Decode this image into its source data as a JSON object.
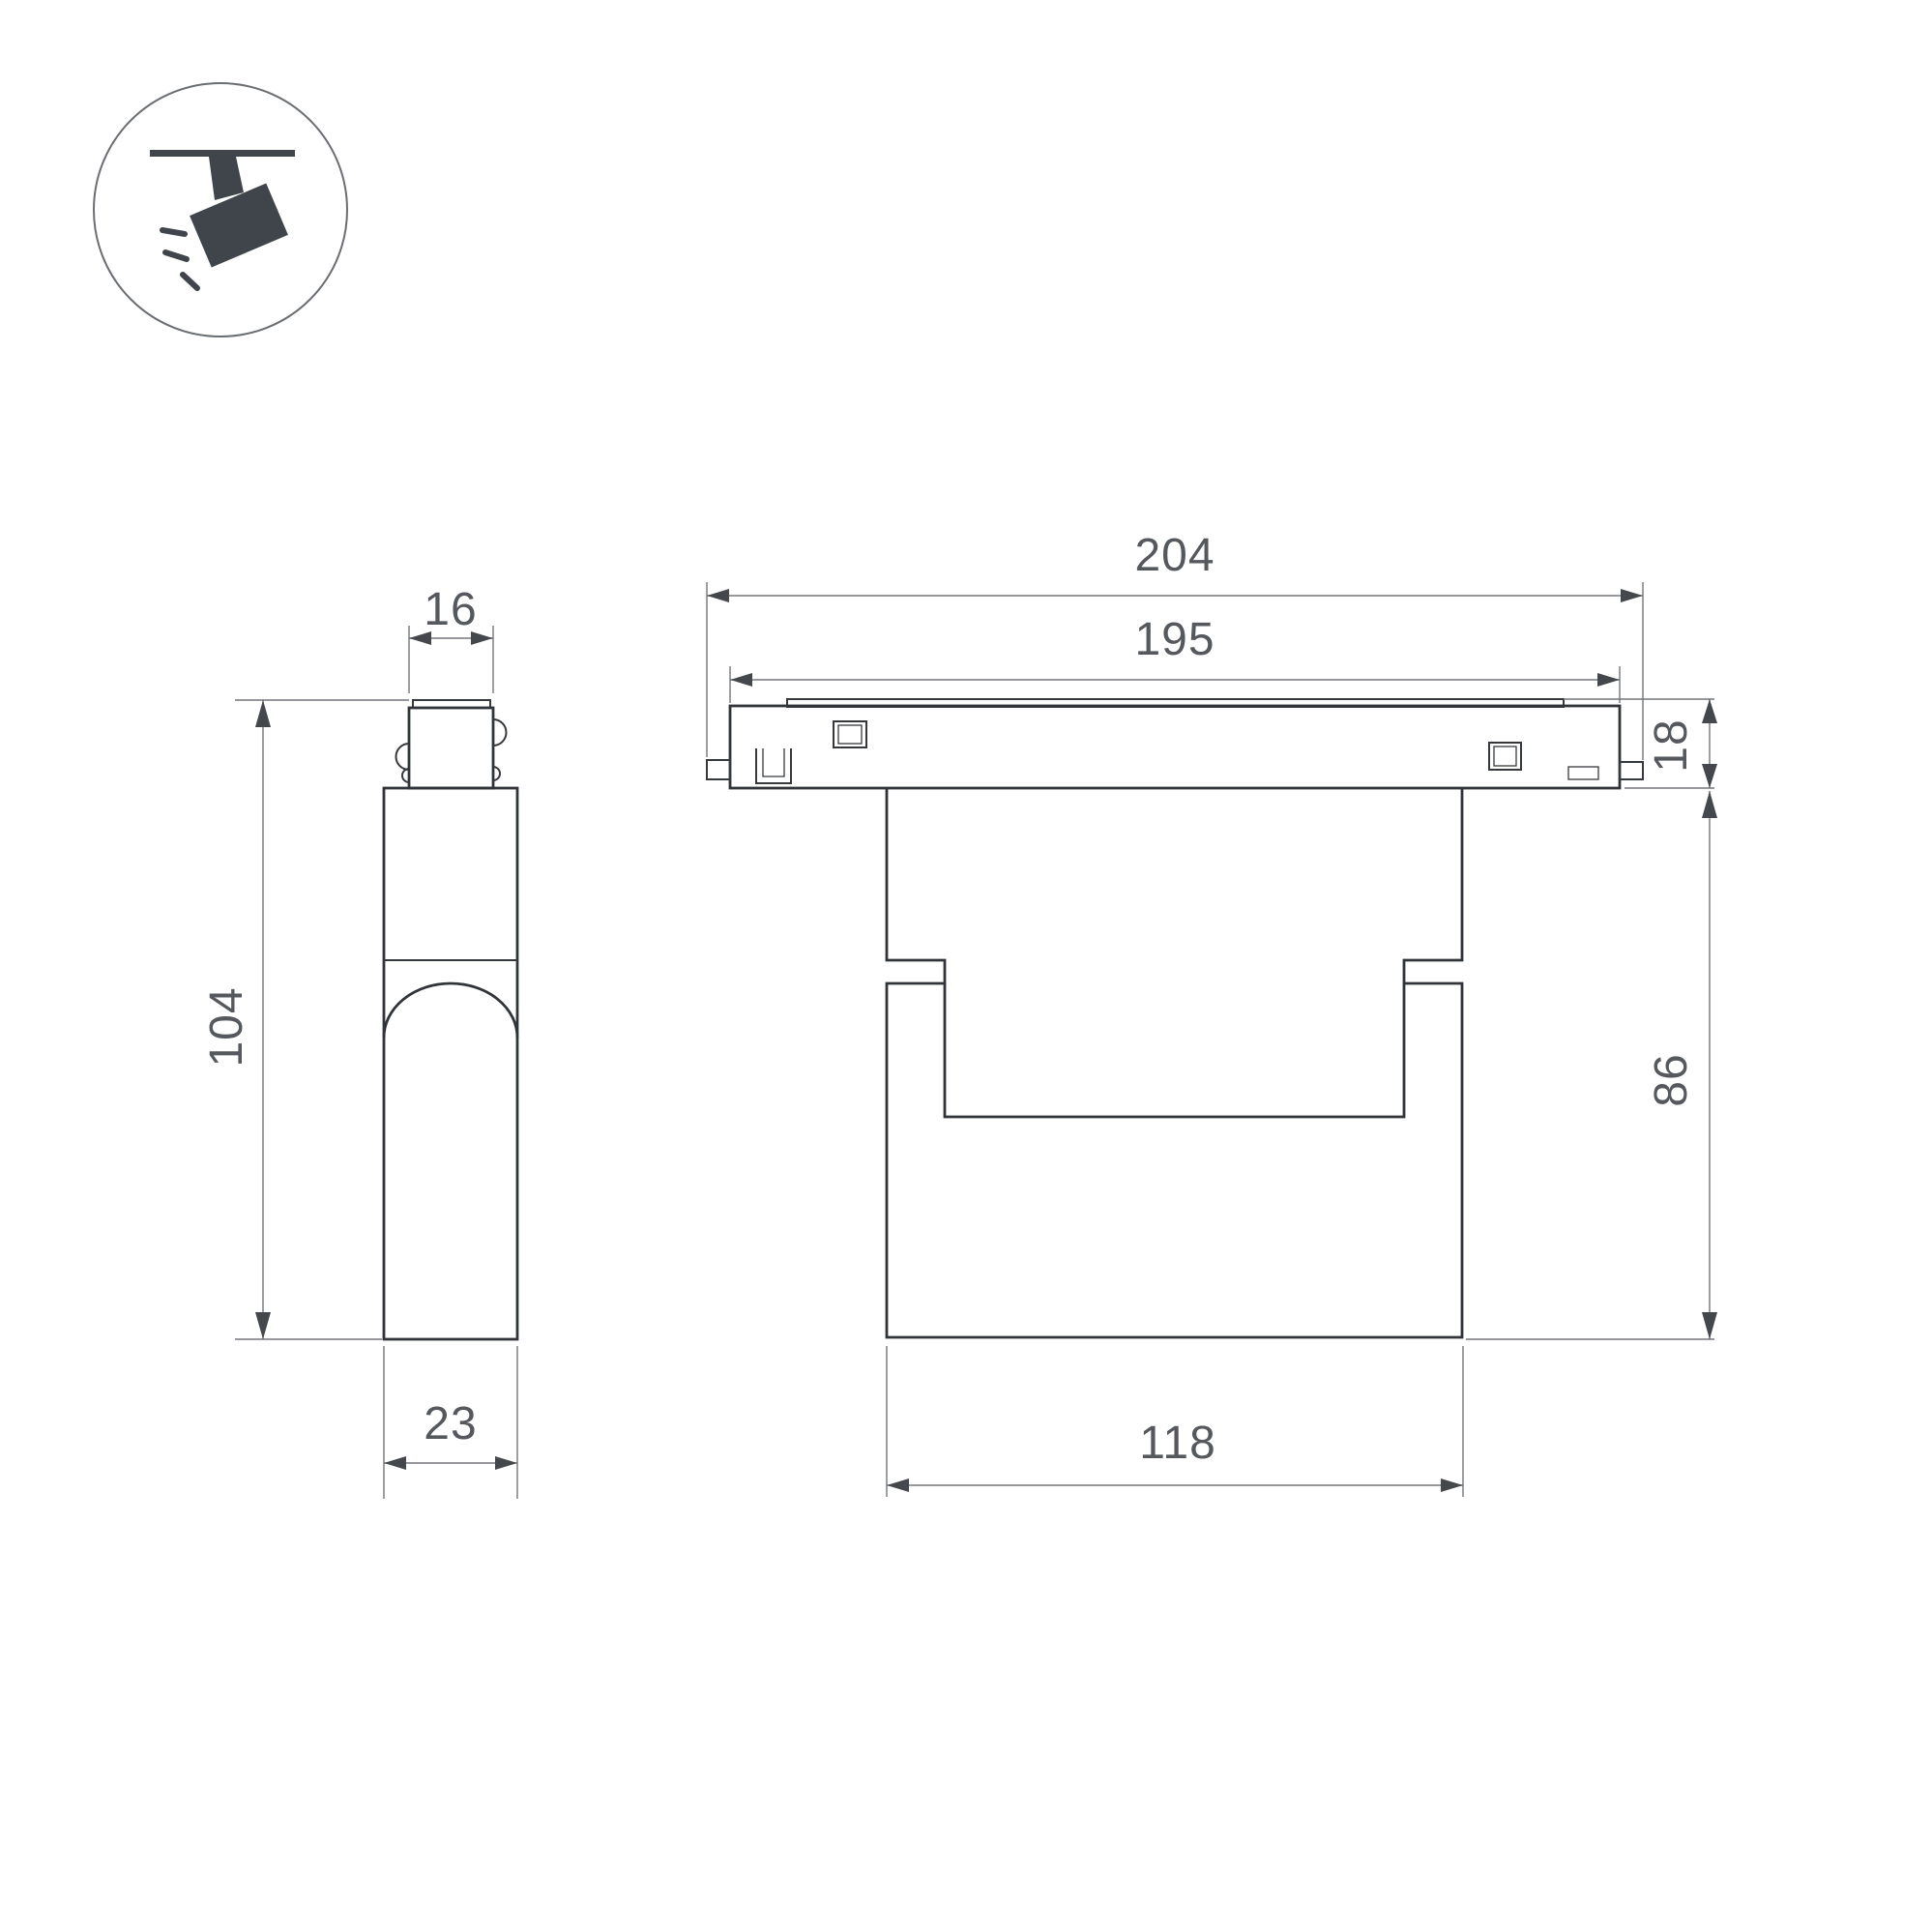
{
  "title": "track-light-dimension-drawing",
  "colors": {
    "background": "#ffffff",
    "drawing_line": "#303438",
    "dimension_line": "#73767a",
    "dimension_text": "#55585c",
    "icon": "#40454b"
  },
  "icon": {
    "name": "ceiling-track-spotlight"
  },
  "side_view": {
    "top_width": "16",
    "height": "104",
    "depth": "23"
  },
  "front_view": {
    "overall_length": "204",
    "track_length": "195",
    "track_height": "18",
    "body_height": "86",
    "body_width": "118"
  }
}
